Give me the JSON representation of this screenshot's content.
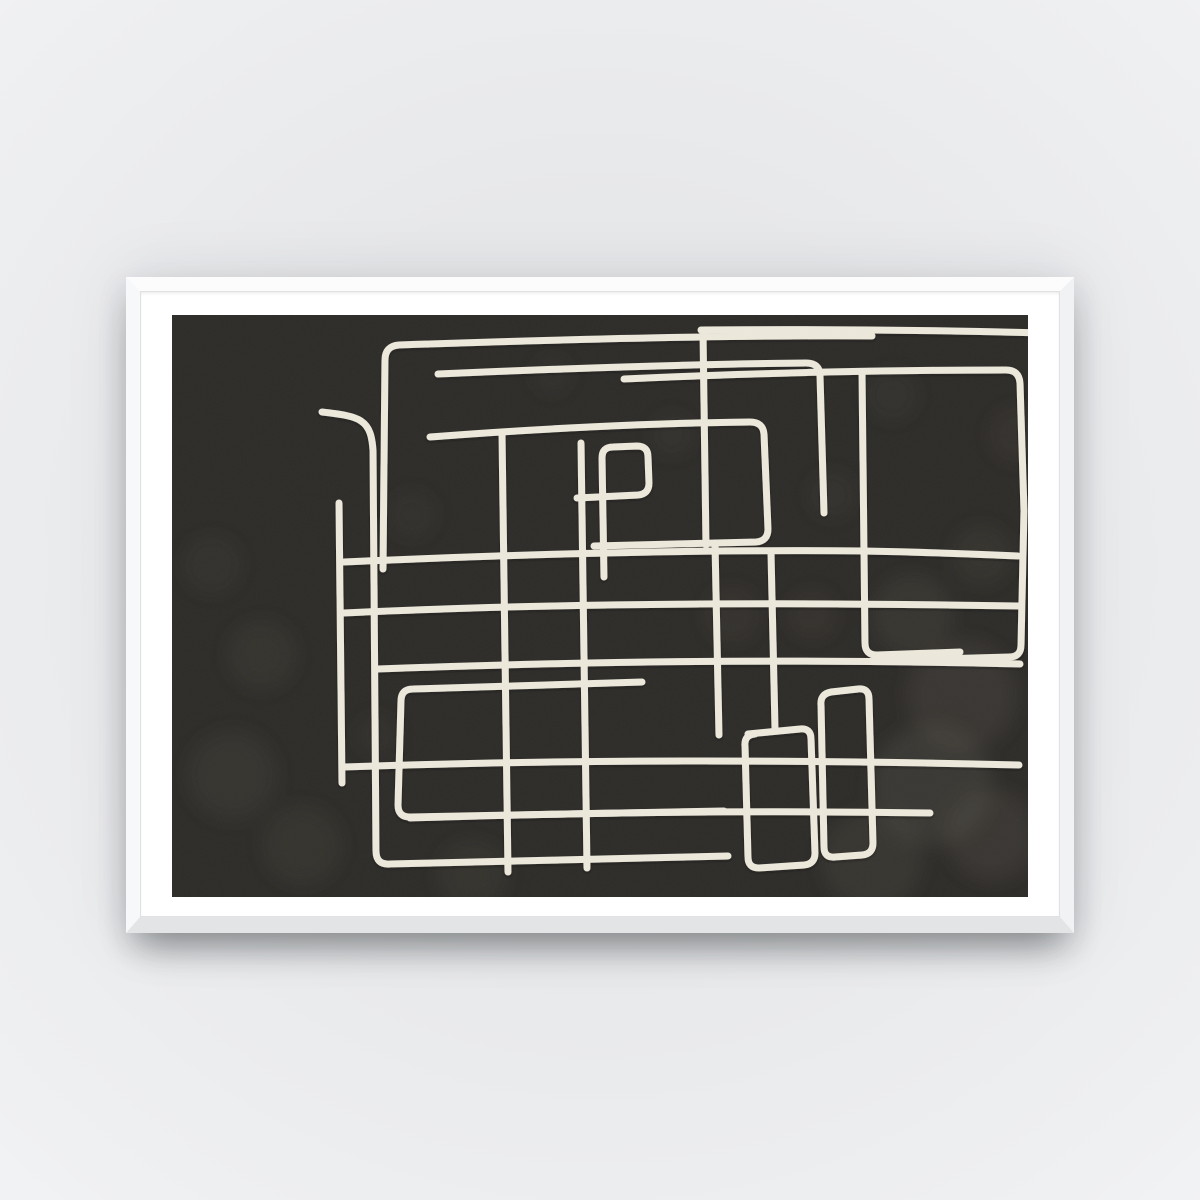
{
  "scene": {
    "description": "Product photograph of a horizontal poster in a thin white frame with a white mat, hanging on a light gray wall with a soft shadow beneath the frame.",
    "artwork_alt": "Abstract one-line maze drawing: cream hand-drawn rectangular labyrinth lines on a textured black-charcoal background"
  },
  "colors": {
    "wall_center": "#e7e8ea",
    "wall_mid": "#eff0f2",
    "wall_edge": "#fafbfb",
    "wall_corner": "#ffffff",
    "frame_face_top": "#fcfcfd",
    "frame_face_left": "#f7f8f9",
    "frame_face_right": "#f1f2f4",
    "frame_face_bottom": "#e3e4e6",
    "frame_lip": "#dfe1e3",
    "mat": "#ffffff",
    "canvas": "#2e2c29",
    "line": "#ebe7da",
    "blob": "#8a8678",
    "line_shadow": "#14120f"
  },
  "artwork": {
    "width": 856,
    "height": 582,
    "line_width": 7,
    "paths": [
      "M 150 97 C 168 99 182 101 189 106 C 198 112 200 122 201 135 L 204 536 Q 204 550 218 549 L 556 541",
      "M 167 188 C 168 290 169 380 170 468",
      "M 211 254 L 213 45 Q 213 31 227 30 C 370 25 540 20 700 21",
      "M 266 59 C 400 53 540 49 634 48 Q 648 48 648 61 L 652 198",
      "M 529 15 C 650 14 760 15 873 18",
      "M 531 17 L 534 230",
      "M 258 122 C 360 114 480 108 578 107 Q 591 107 592 119 L 596 214 Q 596 226 584 227 L 422 231",
      "M 405 183 L 466 180 Q 477 179 477 168 L 476 142 Q 476 131 465 131 L 441 132 Q 430 132 430 143 L 432 262",
      "M 172 247 C 330 240 520 234 692 236 C 750 237 800 239 846 241",
      "M 172 298 C 340 290 560 286 846 291",
      "M 206 354 C 400 347 600 343 848 349",
      "M 172 452 C 350 446 560 443 847 450",
      "M 238 503 C 400 498 560 495 758 498",
      "M 452 64 C 580 58 720 55 834 55 Q 847 55 848 68 L 852 196 L 849 330 Q 849 342 837 342 L 700 346",
      "M 690 57 L 693 328 Q 693 340 705 340 L 788 337",
      "M 659 377 L 686 374 Q 697 373 697 384 L 701 528 Q 701 539 690 540 L 663 542 Q 652 543 652 532 L 649 390 Q 648 379 659 377",
      "M 470 367 L 241 374 Q 229 374 229 386 L 226 490 Q 226 502 238 502 L 552 496",
      "M 576 419 L 628 414 Q 639 413 639 424 L 643 538 Q 643 549 632 550 L 587 553 Q 576 553 576 542 L 573 431 Q 572 420 583 419",
      "M 330 118 C 332 260 334 420 336 557",
      "M 409 128 C 411 280 413 430 415 553",
      "M 543 228 C 544 290 546 360 547 420",
      "M 599 238 L 603 413"
    ],
    "texture_blobs": [
      [
        740,
        300,
        40,
        0.1
      ],
      [
        790,
        380,
        55,
        0.12
      ],
      [
        760,
        470,
        60,
        0.14
      ],
      [
        820,
        520,
        45,
        0.12
      ],
      [
        700,
        545,
        50,
        0.1
      ],
      [
        640,
        300,
        25,
        0.07
      ],
      [
        90,
        340,
        35,
        0.08
      ],
      [
        60,
        460,
        45,
        0.09
      ],
      [
        130,
        530,
        40,
        0.08
      ],
      [
        40,
        250,
        30,
        0.06
      ],
      [
        300,
        560,
        35,
        0.08
      ],
      [
        500,
        120,
        22,
        0.06
      ],
      [
        560,
        300,
        28,
        0.07
      ],
      [
        240,
        200,
        25,
        0.05
      ],
      [
        380,
        60,
        20,
        0.05
      ],
      [
        660,
        180,
        24,
        0.06
      ],
      [
        810,
        240,
        30,
        0.08
      ],
      [
        720,
        80,
        26,
        0.06
      ],
      [
        845,
        120,
        28,
        0.07
      ],
      [
        205,
        420,
        22,
        0.05
      ]
    ]
  }
}
